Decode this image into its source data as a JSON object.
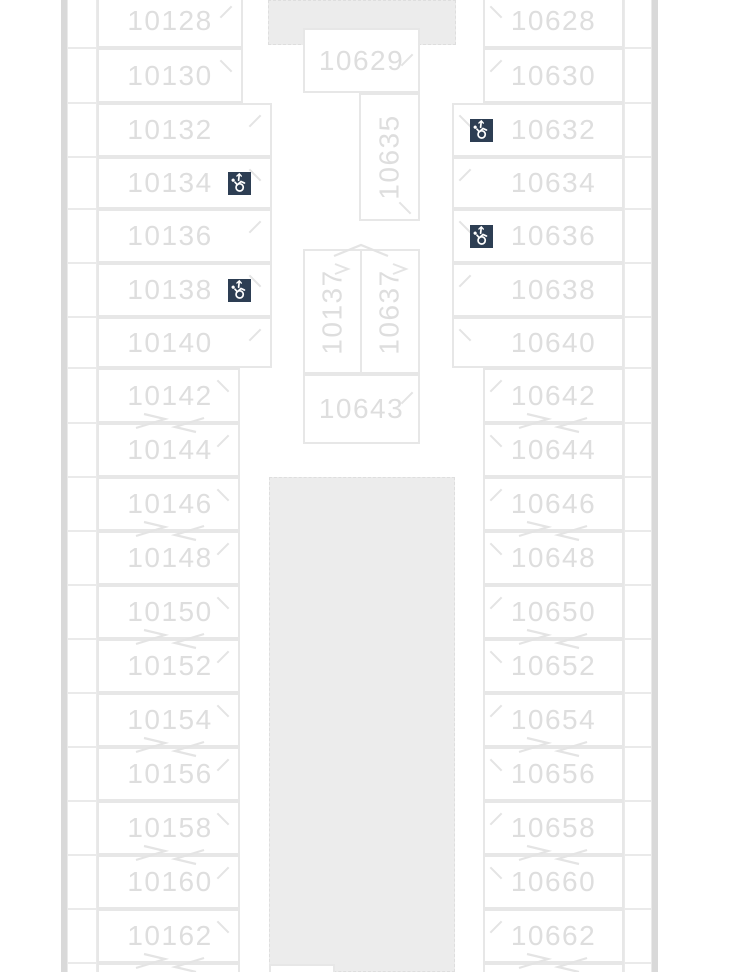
{
  "deck_plan": {
    "name": "cruise-deck-plan-section",
    "left_column": {
      "cabins": [
        {
          "number": "10128",
          "accessible": false
        },
        {
          "number": "10130",
          "accessible": false
        },
        {
          "number": "10132",
          "accessible": false
        },
        {
          "number": "10134",
          "accessible": true
        },
        {
          "number": "10136",
          "accessible": false
        },
        {
          "number": "10138",
          "accessible": true
        },
        {
          "number": "10140",
          "accessible": false
        },
        {
          "number": "10142",
          "accessible": false
        },
        {
          "number": "10144",
          "accessible": false
        },
        {
          "number": "10146",
          "accessible": false
        },
        {
          "number": "10148",
          "accessible": false
        },
        {
          "number": "10150",
          "accessible": false
        },
        {
          "number": "10152",
          "accessible": false
        },
        {
          "number": "10154",
          "accessible": false
        },
        {
          "number": "10156",
          "accessible": false
        },
        {
          "number": "10158",
          "accessible": false
        },
        {
          "number": "10160",
          "accessible": false
        },
        {
          "number": "10162",
          "accessible": false
        }
      ]
    },
    "right_column": {
      "cabins": [
        {
          "number": "10628",
          "accessible": false
        },
        {
          "number": "10630",
          "accessible": false
        },
        {
          "number": "10632",
          "accessible": true
        },
        {
          "number": "10634",
          "accessible": false
        },
        {
          "number": "10636",
          "accessible": true
        },
        {
          "number": "10638",
          "accessible": false
        },
        {
          "number": "10640",
          "accessible": false
        },
        {
          "number": "10642",
          "accessible": false
        },
        {
          "number": "10644",
          "accessible": false
        },
        {
          "number": "10646",
          "accessible": false
        },
        {
          "number": "10648",
          "accessible": false
        },
        {
          "number": "10650",
          "accessible": false
        },
        {
          "number": "10652",
          "accessible": false
        },
        {
          "number": "10654",
          "accessible": false
        },
        {
          "number": "10656",
          "accessible": false
        },
        {
          "number": "10658",
          "accessible": false
        },
        {
          "number": "10660",
          "accessible": false
        },
        {
          "number": "10662",
          "accessible": false
        }
      ]
    },
    "center_column": {
      "cabins": [
        {
          "number": "10629",
          "orientation": "horizontal"
        },
        {
          "number": "10635",
          "orientation": "vertical"
        },
        {
          "number": "10137",
          "orientation": "vertical"
        },
        {
          "number": "10637",
          "orientation": "vertical"
        },
        {
          "number": "10643",
          "orientation": "horizontal"
        }
      ]
    },
    "icons": {
      "accessible_icon": "wheelchair-accessible-stateroom"
    },
    "colors": {
      "cabin_number_text": "#dedede",
      "cabin_border": "#e7e7e7",
      "public_area_fill": "#ececec",
      "hull_band": "#d9d9d9",
      "accessible_icon_bg": "#2d3e53",
      "accessible_icon_glyph": "#ffffff"
    }
  }
}
